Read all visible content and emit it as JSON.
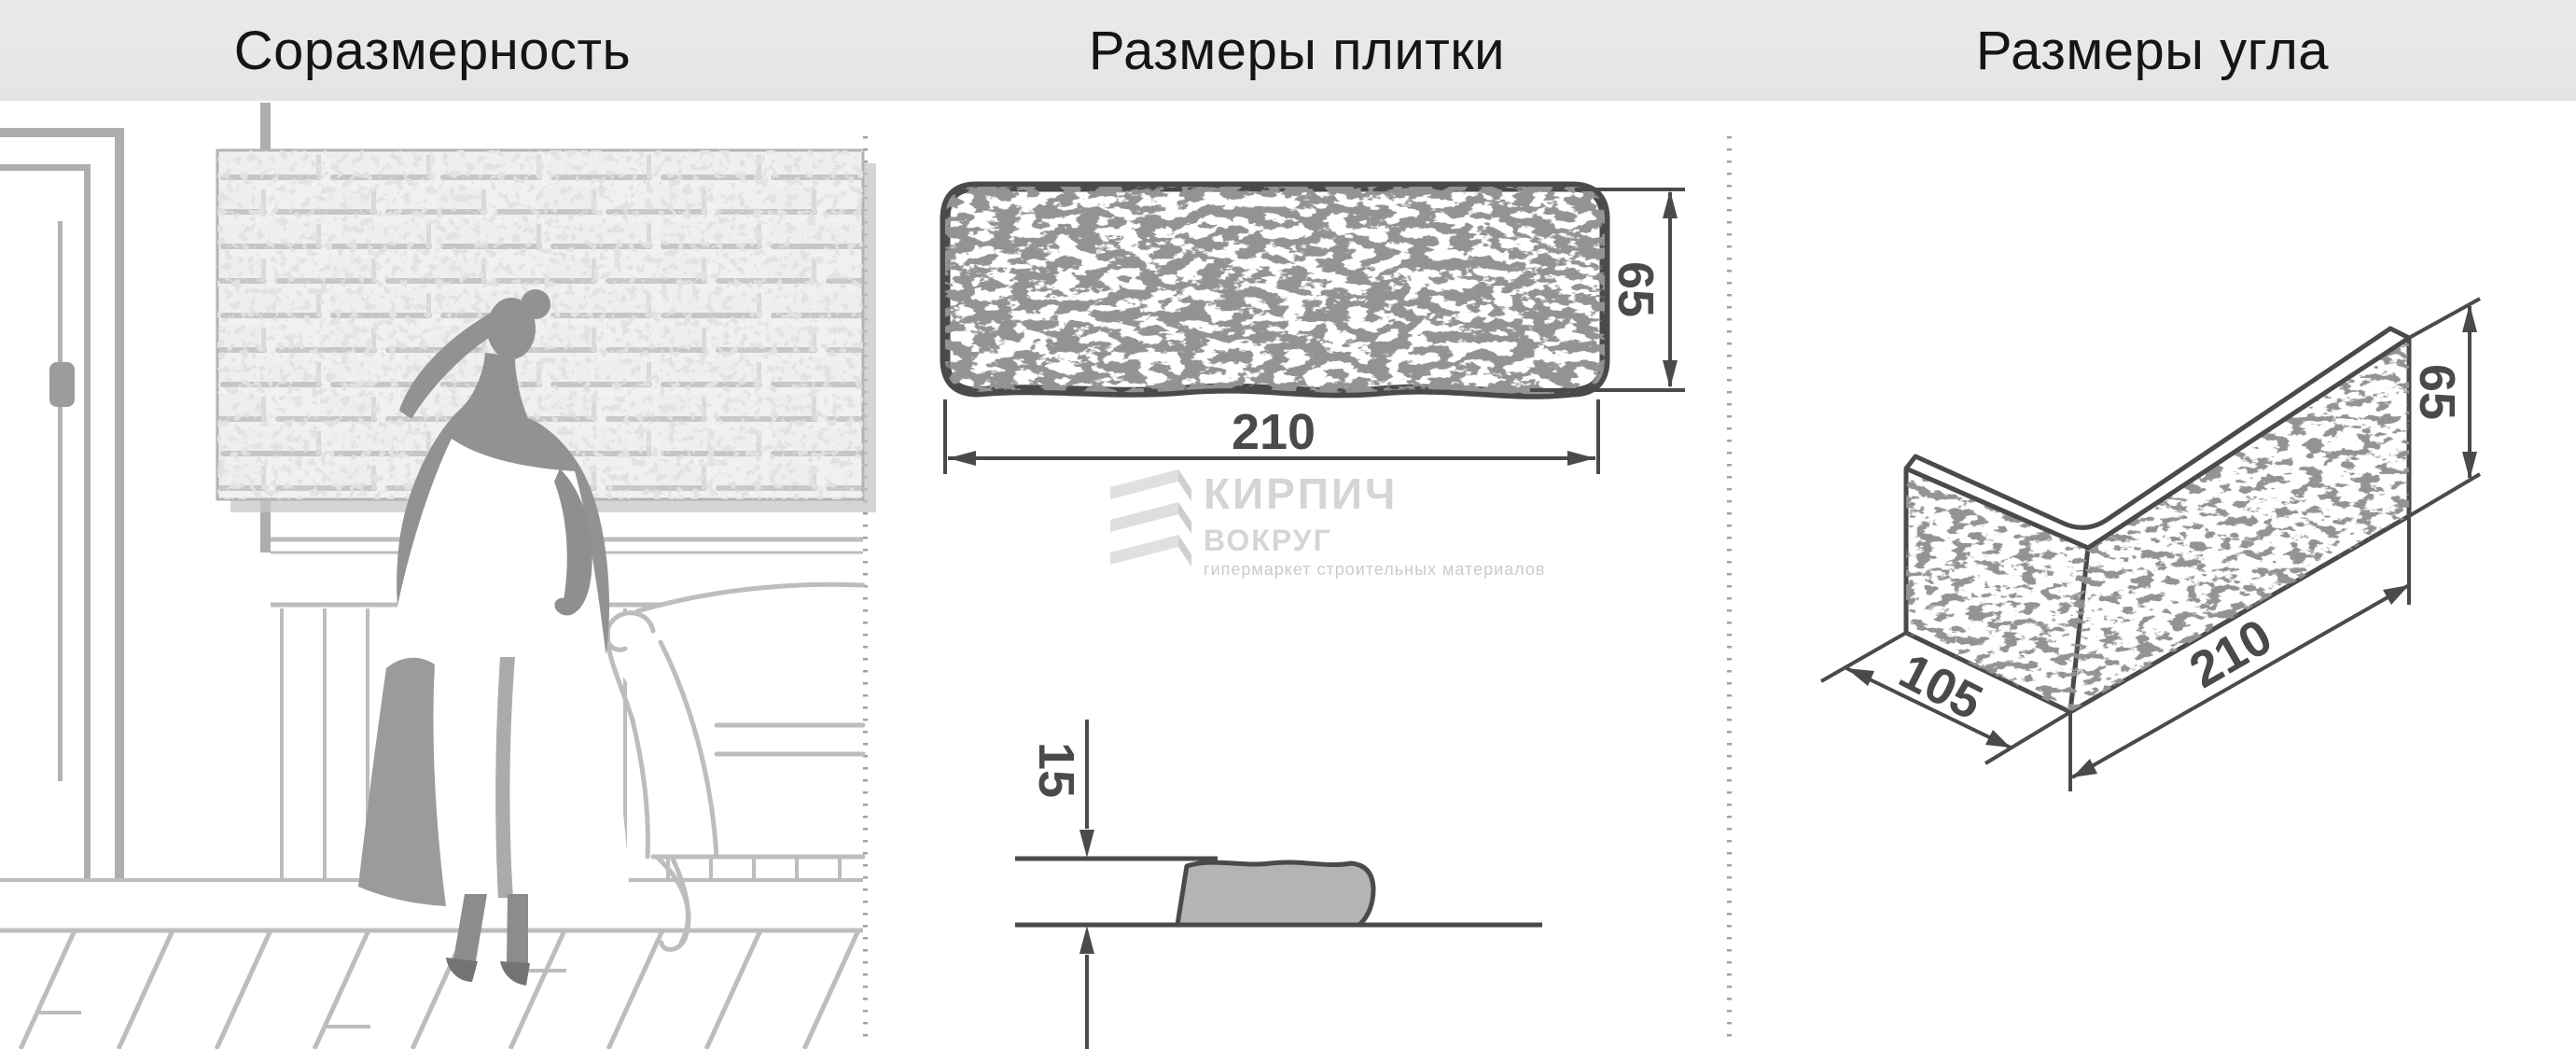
{
  "header": {
    "col1": "Соразмерность",
    "col2": "Размеры плитки",
    "col3": "Размеры угла"
  },
  "tile_view": {
    "length": "210",
    "height": "65",
    "thickness": "15"
  },
  "corner_view": {
    "width": "105",
    "length": "210",
    "height": "65"
  },
  "watermark": {
    "name_top": "КИРПИЧ",
    "name_bottom": "ВОКРУГ",
    "tagline": "гипермаркет строительных материалов"
  },
  "colors": {
    "ink": "#4a4a4a",
    "sketch_gray": "#bdbdbd",
    "header_bg": "#e8e8e8",
    "watermark_gray": "#d5d5d5",
    "section_fill": "#b4b4b4"
  }
}
